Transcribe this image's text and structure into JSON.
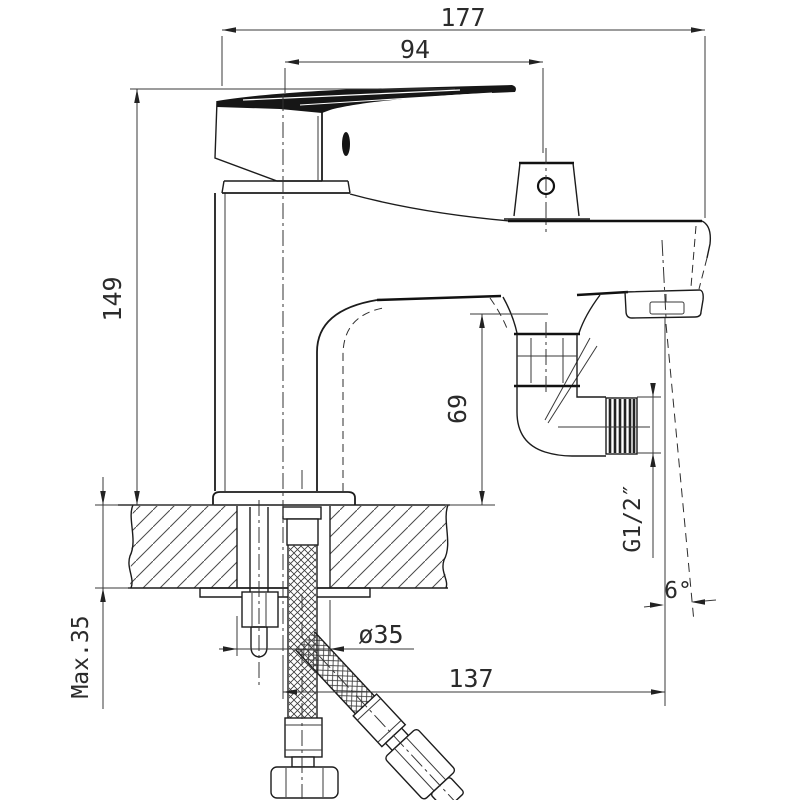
{
  "colors": {
    "background": "#ffffff",
    "line": "#1c1c1c",
    "text": "#2b2b2b"
  },
  "drawing": {
    "labels": {
      "overall_width": "177",
      "upper_width": "94",
      "height": "149",
      "spout_outlet_height": "69",
      "max_mounting_thickness": "Max.35",
      "mounting_hole_diameter": "ø35",
      "lower_offset": "137",
      "hose_thread": "G1/2″",
      "spray_angle": "6°"
    }
  }
}
